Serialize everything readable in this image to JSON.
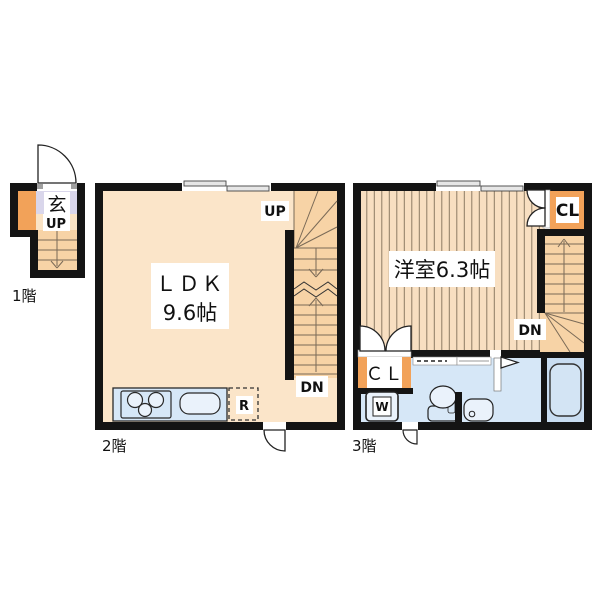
{
  "colors": {
    "wall": "#141414",
    "room_beige": "#FBE5C9",
    "stairs_orange": "#F7D3A6",
    "entry_beige": "#FAE3C5",
    "accent_orange": "#F2A259",
    "entrance_lavender": "#D9D6EB",
    "water_blue": "#D6E7F7",
    "bath_blue": "#C9DDF1",
    "fixture_blue": "#EAF2FB",
    "flooring_stripe_bg": "#F8DFC1"
  },
  "floor1": {
    "name": "1階",
    "entrance": "玄",
    "up": "UP"
  },
  "floor2": {
    "name": "2階",
    "room": "ＬＤＫ",
    "area": "9.6帖",
    "up": "UP",
    "down": "DN",
    "refrigerator": "R"
  },
  "floor3": {
    "name": "3階",
    "room": "洋室6.3帖",
    "closet_upper": "CL",
    "closet_lower": "ＣＬ",
    "washer": "W",
    "down": "DN"
  }
}
